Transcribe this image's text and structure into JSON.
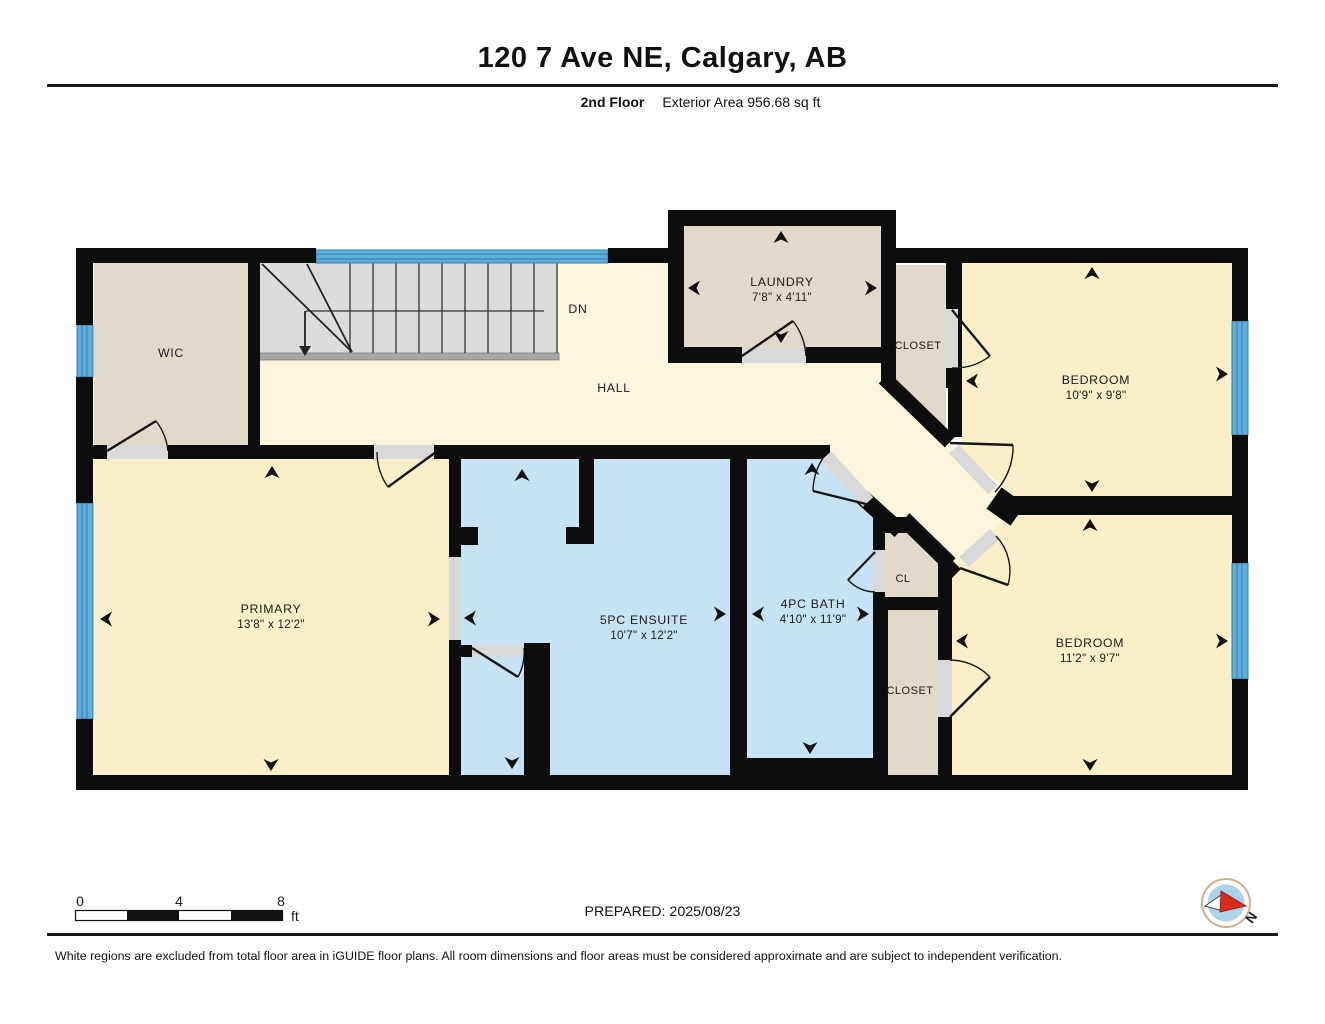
{
  "header": {
    "title": "120 7 Ave NE, Calgary, AB",
    "floor_label": "2nd Floor",
    "area_label": "Exterior Area 956.68 sq ft"
  },
  "rooms": {
    "wic": {
      "name": "WIC"
    },
    "laundry": {
      "name": "LAUNDRY",
      "dims": "7'8\" x 4'11\""
    },
    "closet_top": {
      "name": "CLOSET"
    },
    "bedroom_top": {
      "name": "BEDROOM",
      "dims": "10'9\" x 9'8\""
    },
    "hall": {
      "name": "HALL"
    },
    "stairs": {
      "label": "DN"
    },
    "primary": {
      "name": "PRIMARY",
      "dims": "13'8\" x 12'2\""
    },
    "ensuite": {
      "name": "5PC ENSUITE",
      "dims": "10'7\" x 12'2\""
    },
    "bath": {
      "name": "4PC BATH",
      "dims": "4'10\" x 11'9\""
    },
    "cl": {
      "name": "CL"
    },
    "closet_bottom": {
      "name": "CLOSET"
    },
    "bedroom_bottom": {
      "name": "BEDROOM",
      "dims": "11'2\" x 9'7\""
    }
  },
  "scale_bar": {
    "tick_0": "0",
    "tick_4": "4",
    "tick_8": "8",
    "unit": "ft"
  },
  "prepared_label": "PREPARED: 2025/08/23",
  "compass": {
    "north_label": "N"
  },
  "footer": {
    "disclaimer": "White regions are excluded from total floor area in iGUIDE floor plans. All room dimensions and floor areas must be considered approximate and are subject to independent verification."
  },
  "colors": {
    "wall": "#0d0d0d",
    "room_cream": "#FAEFC9",
    "hall_cream": "#FCF5DE",
    "closet_beige": "#E1DACA",
    "bath_blue": "#C6E3F5",
    "stair_gray": "#DCDCDC",
    "window_blue": "#5FAEDC",
    "threshold_gray": "#D9D9D9",
    "compass_red": "#D62D20"
  }
}
